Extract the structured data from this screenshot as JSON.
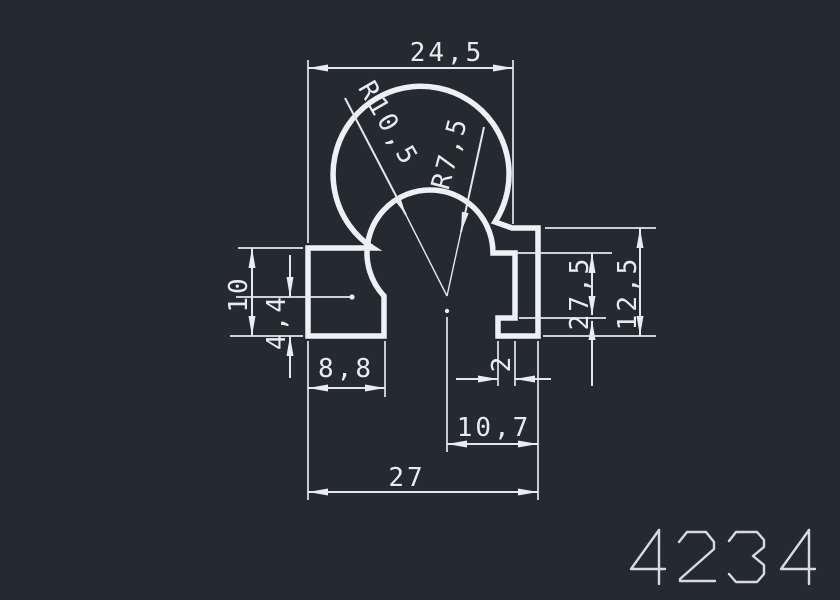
{
  "drawing": {
    "part_number": "4234",
    "background_color": "#252a31",
    "line_color": "#e9ecef",
    "dimensions": {
      "top_width": "24,5",
      "outer_radius": "R10,5",
      "inner_radius": "R7,5",
      "left_height": "10",
      "left_offset": "4,4",
      "tab_width": "8,8",
      "notch_width": "2",
      "offset_width": "10,7",
      "total_width": "27",
      "right_inner_height": "27,5",
      "right_height": "12,5"
    }
  }
}
